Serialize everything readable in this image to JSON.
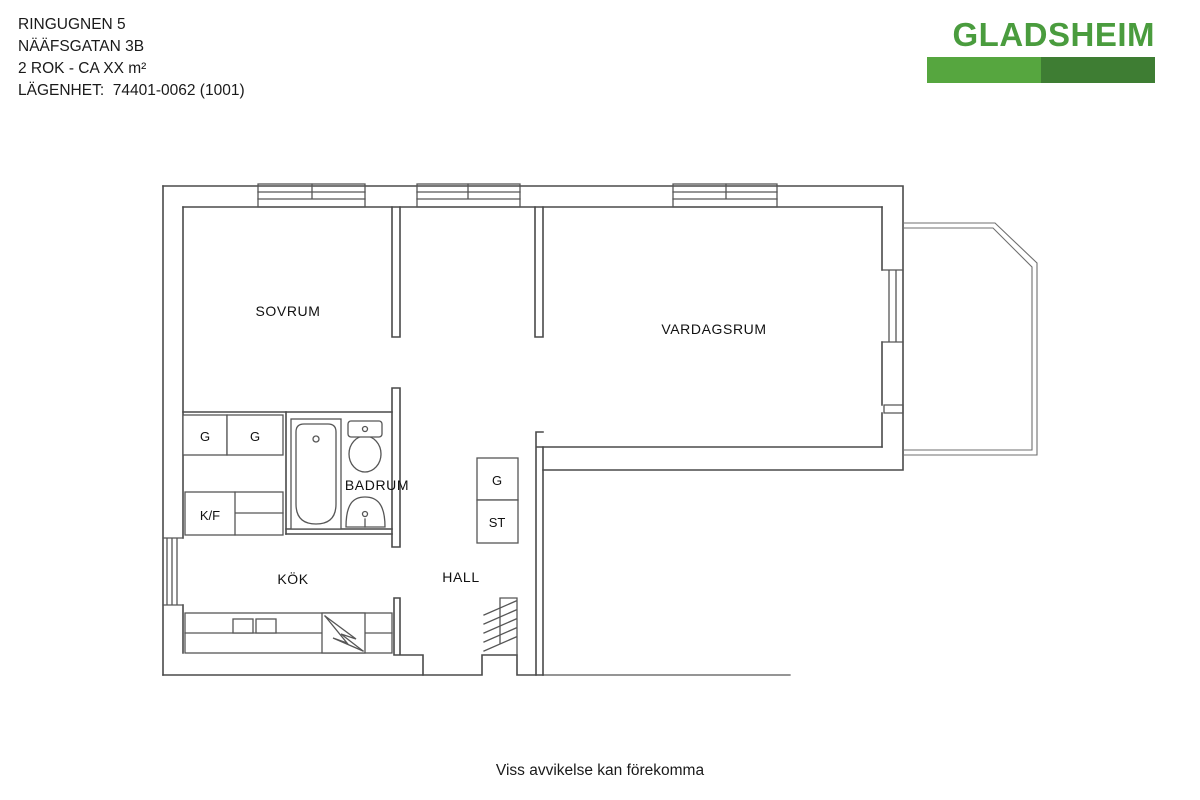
{
  "header": {
    "property_name": "RINGUGNEN 5",
    "address": "NÄÄFSGATAN 3B",
    "size_line": "2 ROK - CA XX m²",
    "apartment_line": "LÄGENHET:  74401-0062 (1001)"
  },
  "logo": {
    "name": "GLADSHEIM"
  },
  "plan": {
    "bedroom": "SOVRUM",
    "living_room": "VARDAGSRUM",
    "bathroom": "BADRUM",
    "kitchen": "KÖK",
    "hall": "HALL",
    "closet_a": "G",
    "closet_b": "G",
    "fridge_freezer": "K/F",
    "hall_closet": "G",
    "cleaning_closet": "ST"
  },
  "footer": {
    "disclaimer": "Viss avvikelse kan förekomma"
  },
  "colors": {
    "logo_text": "#4a9c3e",
    "logo_bar_left": "#56a63f",
    "logo_bar_right": "#3e7d33",
    "plan_lines": "#4a4a4a",
    "text": "#1a1a1a"
  }
}
